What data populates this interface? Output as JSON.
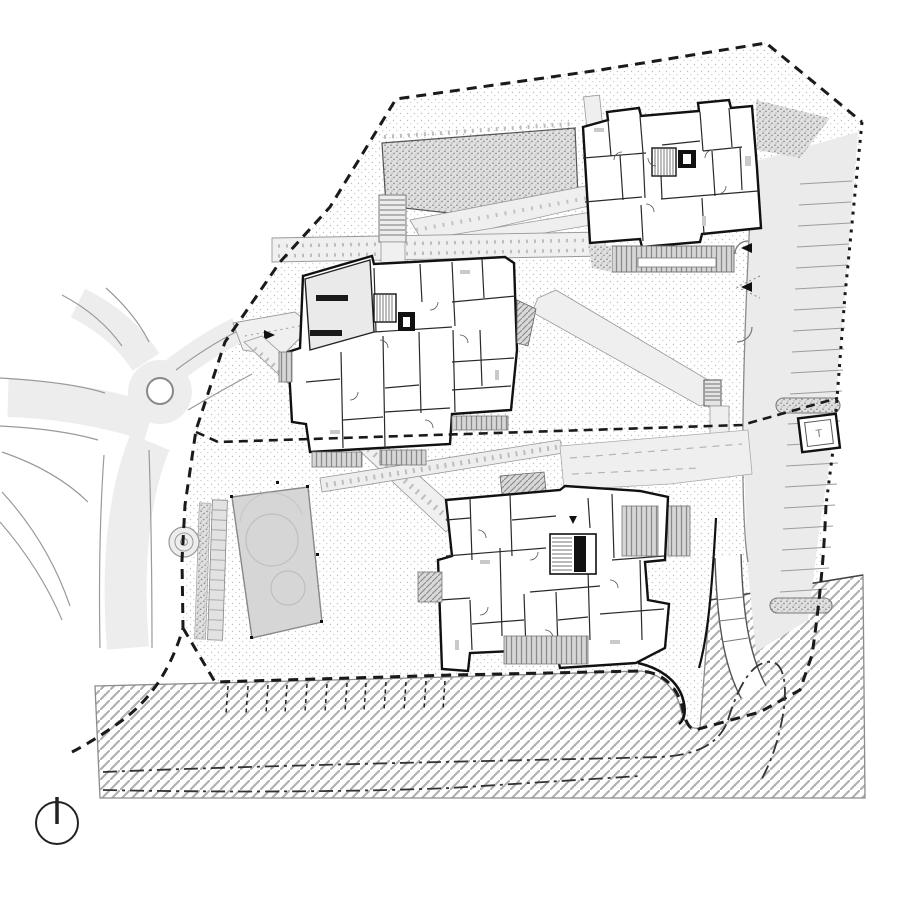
{
  "drawing": {
    "title": "Residential site plan — ground floor",
    "type": "architectural site plan",
    "labels": {
      "transformer": "T"
    },
    "symbols": {
      "north_indicator": "north-arrow-icon",
      "elevator_marker": "black box with white cab square",
      "site_boundary": "bold dashed line",
      "parcel_edge_east": "dotted line",
      "utility_line": "dash-dot line"
    },
    "areas": [
      "building-north",
      "building-middle",
      "building-south",
      "roundabout",
      "access-road",
      "parking-east",
      "parking-south-stalls",
      "sport-court",
      "playground-spiral",
      "embankment-slope",
      "gravel-planting",
      "courtyard-terrace",
      "footpath-network",
      "transformer-station"
    ],
    "colors": {
      "paper": "#ffffff",
      "ink": "#1a1a1a",
      "ground_stipple": "#bdbdbd",
      "dense_stipple": "#8d8d8d",
      "road_fill": "#ededed",
      "path_fill": "#f0f0f0",
      "court_fill": "#d6d6d6",
      "balcony_hatch": "#8f8f8f",
      "slope_hatch": "#b0b0b0"
    }
  }
}
